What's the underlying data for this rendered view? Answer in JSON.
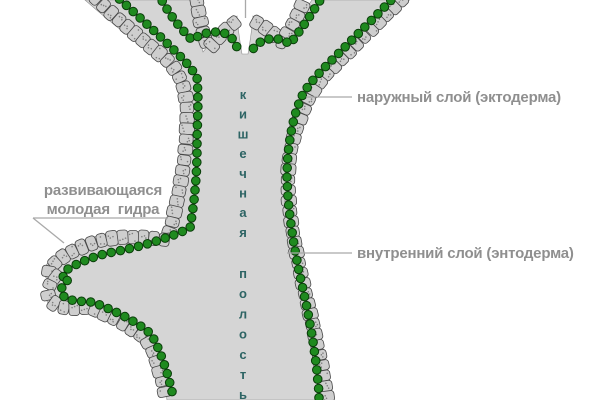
{
  "figure": {
    "title_hint": "hydra longitudinal section diagram",
    "labels": {
      "outer_layer": "наружный слой (эктодерма)",
      "inner_layer": "внутренний слой (энтодерма)",
      "bud_line1": "развивающаяся",
      "bud_line2": "молодая  гидра",
      "cavity_vertical": "кишечная полость"
    },
    "colors": {
      "background": "#ffffff",
      "body_fill": "#d5d5d5",
      "body_edge": "#8f8f8f",
      "ectoderm_cell_fill": "#cecece",
      "ectoderm_cell_stroke": "#474747",
      "speckle": "#7f7f7f",
      "endoderm_cell_fill": "#1f8a1f",
      "endoderm_cell_stroke": "#0a3d0a",
      "label_text": "#8f8f8f",
      "leader_line": "#a9a9a9",
      "cavity_text": "#2d6464"
    }
  }
}
